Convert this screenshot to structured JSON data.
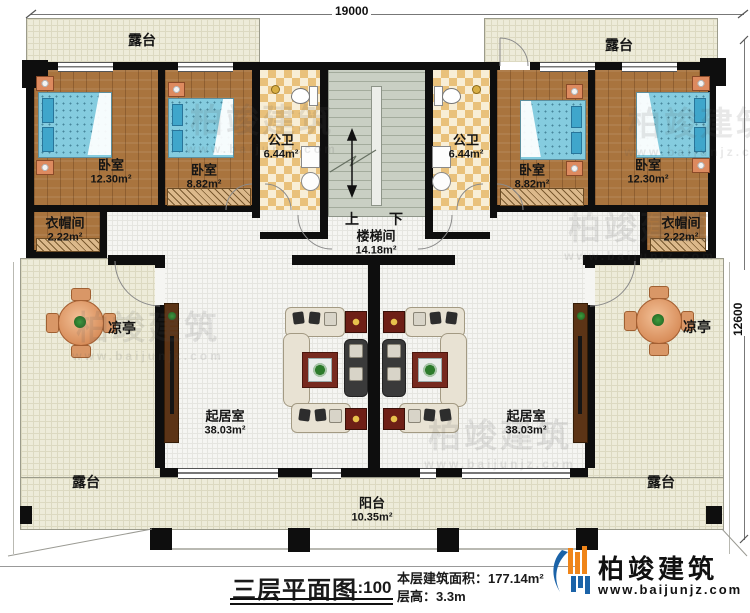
{
  "dims": {
    "top": "19000",
    "right": "12600"
  },
  "rooms": {
    "terrace_top_left": {
      "label": "露台"
    },
    "terrace_top_right": {
      "label": "露台"
    },
    "terrace_bottom_left": {
      "label": "露台"
    },
    "terrace_bottom_right": {
      "label": "露台"
    },
    "bedroom_a": {
      "label": "卧室",
      "area": "12.30m²"
    },
    "bedroom_b": {
      "label": "卧室",
      "area": "8.82m²"
    },
    "bedroom_c": {
      "label": "卧室",
      "area": "8.82m²"
    },
    "bedroom_d": {
      "label": "卧室",
      "area": "12.30m²"
    },
    "bath_left": {
      "label": "公卫",
      "area": "6.44m²"
    },
    "bath_right": {
      "label": "公卫",
      "area": "6.44m²"
    },
    "cloak_left": {
      "label": "衣帽间",
      "area": "2.22m²"
    },
    "cloak_right": {
      "label": "衣帽间",
      "area": "2.22m²"
    },
    "stairwell": {
      "label": "楼梯间",
      "area": "14.18m²",
      "up": "上",
      "down": "下"
    },
    "pavilion_left": {
      "label": "凉亭"
    },
    "pavilion_right": {
      "label": "凉亭"
    },
    "living_left": {
      "label": "起居室",
      "area": "38.03m²"
    },
    "living_right": {
      "label": "起居室",
      "area": "38.03m²"
    },
    "balcony": {
      "label": "阳台",
      "area": "10.35m²"
    }
  },
  "footer": {
    "title": "三层平面图",
    "scale": "1:100",
    "area_label": "本层建筑面积：",
    "area_value": "177.14m²",
    "height_label": "层高：",
    "height_value": "3.3m"
  },
  "brand": {
    "name": "柏竣建筑",
    "website": "www.baijunjz.com"
  },
  "watermark": {
    "name": "柏竣建筑",
    "website": "www.baijunjz.com"
  },
  "colors": {
    "wall": "#0e0e0e",
    "wood_floor": "#a9743e",
    "terrace_floor": "#edebd9",
    "bath_tile": "#e9c17b",
    "stair_floor": "#c9cfc3",
    "bed_blue": "#85ccdf",
    "rug_red": "#772a1f",
    "logo_blue": "#1b63a8",
    "logo_orange": "#f08519"
  }
}
